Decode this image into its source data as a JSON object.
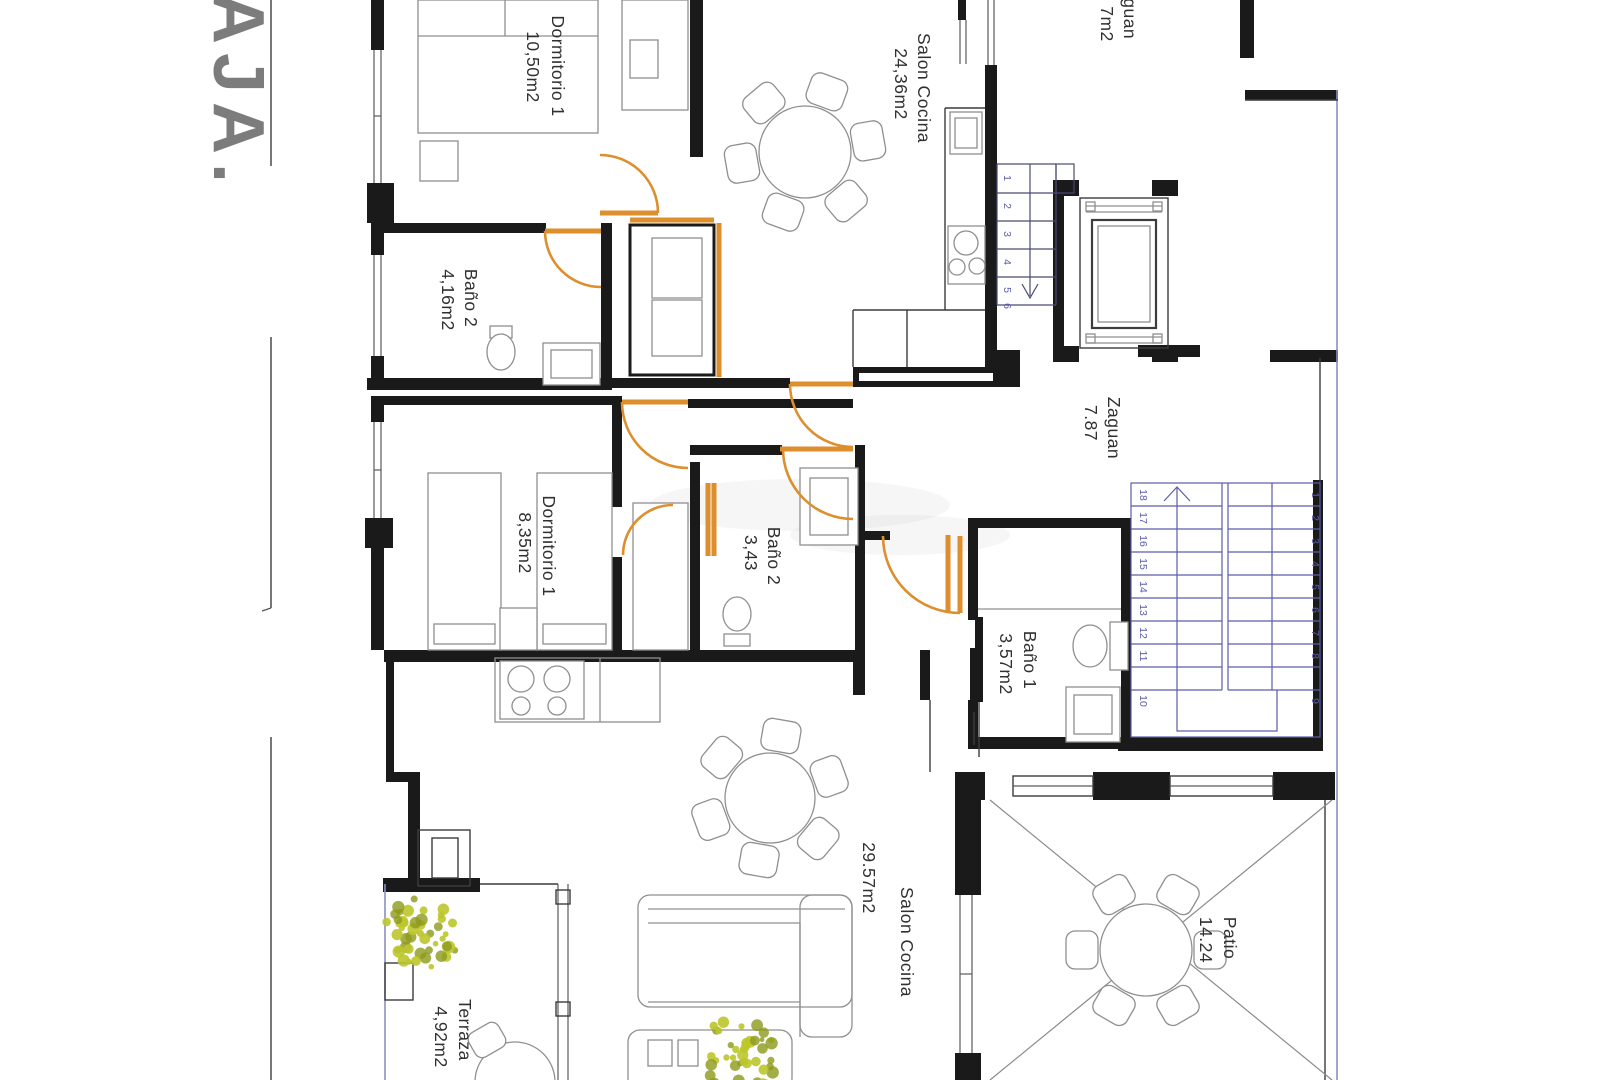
{
  "title": {
    "text": "AJA.",
    "color": "#7c7c7c"
  },
  "plan": {
    "rooms": [
      {
        "name": "Dormitorio 1",
        "area": "10,50m2"
      },
      {
        "name": "Salon Cocina",
        "area": "24,36m2"
      },
      {
        "name": "Baño 2",
        "area": "4,16m2"
      },
      {
        "name": "Zaguan",
        "area": "7m2"
      },
      {
        "name": "Zaguan",
        "area": "7.87"
      },
      {
        "name": "Dormitorio 1",
        "area": "8,35m2"
      },
      {
        "name": "Baño 2",
        "area": "3,43"
      },
      {
        "name": "Baño 1",
        "area": "3,57m2"
      },
      {
        "name": "Salon Cocina",
        "area": "29.57m2"
      },
      {
        "name": "Terraza",
        "area": "4,92m2"
      },
      {
        "name": "Patio",
        "area": "14.24"
      }
    ],
    "stairs": {
      "upper_numbers": [
        "1",
        "2",
        "3",
        "4",
        "5",
        "6"
      ],
      "lower_left_numbers": [
        "18",
        "17",
        "16",
        "15",
        "14",
        "13",
        "12",
        "11",
        "10"
      ],
      "lower_right_numbers": [
        "1",
        "2",
        "3",
        "4",
        "5",
        "6",
        "7",
        "8",
        "9"
      ]
    }
  },
  "colors": {
    "door_orange": "#dd8e2d",
    "stair_blue": "#5c5cab",
    "wall_black": "#1a1a1a",
    "furniture_gray": "#8f8f8f",
    "plant_green": "#bcc72b",
    "plant_green_dark": "#8d9a1c",
    "title_gray": "#7c7c7c",
    "boundary_blue": "#8b90c0",
    "label_color": "#303030"
  }
}
